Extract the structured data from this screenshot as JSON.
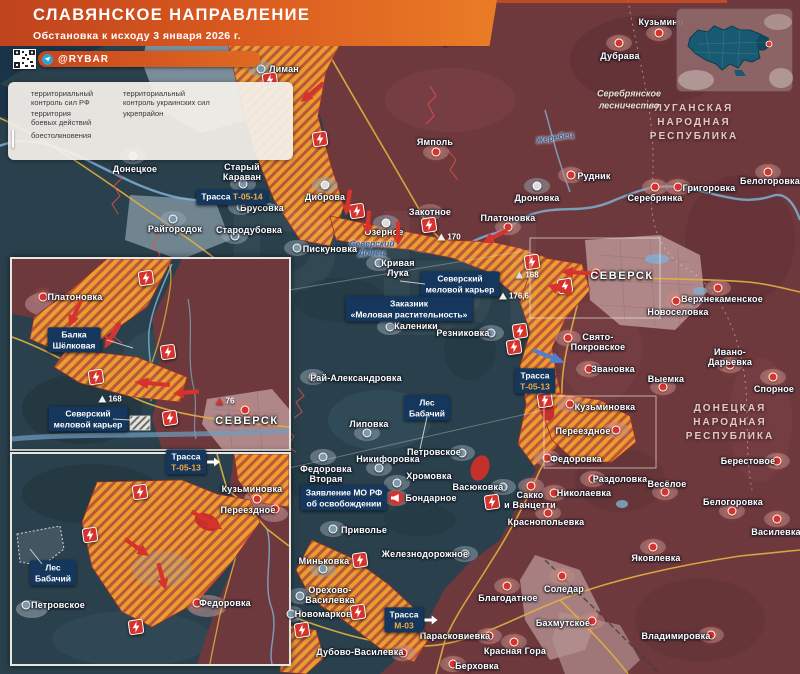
{
  "title": {
    "line1": "СЛАВЯНСКОЕ НАПРАВЛЕНИЕ",
    "line2": "Обстановка к исходу 3 января 2026 г."
  },
  "branding": {
    "handle": "@RYBAR"
  },
  "legend": {
    "items": [
      {
        "icon": "hex-red",
        "label": "территориальный\nконтроль сил РФ"
      },
      {
        "icon": "hex-blue",
        "label": "территориальный\nконтроль украинских сил"
      },
      {
        "icon": "hex-hatch",
        "label": "территория\nбоевых действий"
      },
      {
        "icon": "line-red",
        "label": "укрепрайон"
      },
      {
        "icon": "badge-lightning",
        "label": "боестолкновения"
      }
    ]
  },
  "region_labels": [
    {
      "t": "ЛУГАНСКАЯ\nНАРОДНАЯ\nРЕСПУБЛИКА",
      "x": 694,
      "y": 123
    },
    {
      "t": "ДОНЕЦКАЯ\nНАРОДНАЯ\nРЕСПУБЛИКА",
      "x": 730,
      "y": 423
    }
  ],
  "area_labels": [
    {
      "t": "Серебрянское\nлесничество",
      "x": 629,
      "y": 100
    }
  ],
  "river_labels": [
    {
      "t": "Жеребец",
      "x": 555,
      "y": 138,
      "r": -10
    },
    {
      "t": "Северский\nДонец",
      "x": 372,
      "y": 249,
      "r": 0
    }
  ],
  "towns": [
    {
      "name": "Лиман",
      "m": "blue",
      "x": 261,
      "y": 69,
      "lx": 284,
      "ly": 69
    },
    {
      "name": "Заречное",
      "m": "red",
      "x": 417,
      "y": 21,
      "lx": 417,
      "ly": 12
    },
    {
      "name": "Торское",
      "m": "red",
      "x": 452,
      "y": 31,
      "lx": 452,
      "ly": 41
    },
    {
      "name": "Кузьмино",
      "m": "red",
      "x": 659,
      "y": 33,
      "lx": 661,
      "ly": 22
    },
    {
      "name": "Дубрава",
      "m": "red",
      "x": 619,
      "y": 43,
      "lx": 620,
      "ly": 56
    },
    {
      "name": "Ямполь",
      "m": "red",
      "x": 436,
      "y": 152,
      "lx": 435,
      "ly": 142
    },
    {
      "name": "Диброва",
      "m": "gray",
      "x": 325,
      "y": 185,
      "lx": 325,
      "ly": 197
    },
    {
      "name": "Дроновка",
      "m": "gray",
      "x": 537,
      "y": 186,
      "lx": 537,
      "ly": 198
    },
    {
      "name": "Платоновка",
      "m": "red",
      "x": 508,
      "y": 227,
      "lx": 508,
      "ly": 218
    },
    {
      "name": "Закотное",
      "m": "none",
      "x": 0,
      "y": 0,
      "lx": 430,
      "ly": 212
    },
    {
      "name": "Озерное",
      "m": "gray",
      "x": 386,
      "y": 223,
      "lx": 384,
      "ly": 232
    },
    {
      "name": "Пискуновка",
      "m": "blue",
      "x": 297,
      "y": 248,
      "lx": 330,
      "ly": 249
    },
    {
      "name": "Кривая\nЛука",
      "m": "blue",
      "x": 379,
      "y": 263,
      "lx": 398,
      "ly": 268
    },
    {
      "name": "СЕВЕРСК",
      "m": "red",
      "x": 596,
      "y": 273,
      "lx": 622,
      "ly": 276,
      "big": true
    },
    {
      "name": "Верхнекаменское",
      "m": "red",
      "x": 718,
      "y": 288,
      "lx": 722,
      "ly": 299
    },
    {
      "name": "Новоселовка",
      "m": "red",
      "x": 676,
      "y": 301,
      "lx": 678,
      "ly": 312
    },
    {
      "name": "Свято-\nПокровское",
      "m": "red",
      "x": 568,
      "y": 338,
      "lx": 598,
      "ly": 342
    },
    {
      "name": "Звановка",
      "m": "red",
      "x": 589,
      "y": 369,
      "lx": 613,
      "ly": 369
    },
    {
      "name": "Резниковка",
      "m": "blue",
      "x": 491,
      "y": 333,
      "lx": 463,
      "ly": 333
    },
    {
      "name": "Каленики",
      "m": "blue",
      "x": 390,
      "y": 327,
      "lx": 416,
      "ly": 326
    },
    {
      "name": "Рай-Александровка",
      "m": "blue",
      "x": 313,
      "y": 377,
      "lx": 356,
      "ly": 378
    },
    {
      "name": "Липовка",
      "m": "blue",
      "x": 367,
      "y": 433,
      "lx": 369,
      "ly": 424
    },
    {
      "name": "Никифоровка",
      "m": "blue",
      "x": 379,
      "y": 468,
      "lx": 388,
      "ly": 459
    },
    {
      "name": "Петровское",
      "m": "blue",
      "x": 462,
      "y": 453,
      "lx": 434,
      "ly": 452
    },
    {
      "name": "Федоровка\nВторая",
      "m": "blue",
      "x": 323,
      "y": 457,
      "lx": 326,
      "ly": 474
    },
    {
      "name": "Хромовка",
      "m": "blue",
      "x": 397,
      "y": 483,
      "lx": 429,
      "ly": 476
    },
    {
      "name": "Васюковка",
      "m": "blue",
      "x": 503,
      "y": 487,
      "lx": 478,
      "ly": 487
    },
    {
      "name": "Бондарное",
      "m": "announce",
      "x": 396,
      "y": 498,
      "lx": 431,
      "ly": 498
    },
    {
      "name": "Сакко\nи Ванцетти",
      "m": "red",
      "x": 531,
      "y": 486,
      "lx": 530,
      "ly": 500
    },
    {
      "name": "Краснопольевка",
      "m": "red",
      "x": 548,
      "y": 513,
      "lx": 546,
      "ly": 522
    },
    {
      "name": "Николаевка",
      "m": "red",
      "x": 554,
      "y": 493,
      "lx": 584,
      "ly": 493
    },
    {
      "name": "Раздоловка",
      "m": "red",
      "x": 593,
      "y": 479,
      "lx": 620,
      "ly": 479
    },
    {
      "name": "Приволье",
      "m": "blue",
      "x": 333,
      "y": 529,
      "lx": 364,
      "ly": 530
    },
    {
      "name": "Железнодорожное",
      "m": "blue",
      "x": 465,
      "y": 554,
      "lx": 425,
      "ly": 554
    },
    {
      "name": "Миньковка",
      "m": "blue",
      "x": 323,
      "y": 569,
      "lx": 324,
      "ly": 561
    },
    {
      "name": "Орехово-\nВасилевка",
      "m": "blue",
      "x": 300,
      "y": 596,
      "lx": 330,
      "ly": 595
    },
    {
      "name": "Новомарково",
      "m": "blue",
      "x": 291,
      "y": 614,
      "lx": 326,
      "ly": 614
    },
    {
      "name": "Дубово-Василевка",
      "m": "red",
      "x": 403,
      "y": 653,
      "lx": 360,
      "ly": 652
    },
    {
      "name": "Парасковиевка",
      "m": "red",
      "x": 489,
      "y": 636,
      "lx": 455,
      "ly": 636
    },
    {
      "name": "Благодатное",
      "m": "red",
      "x": 507,
      "y": 586,
      "lx": 508,
      "ly": 598
    },
    {
      "name": "Красная Гора",
      "m": "red",
      "x": 514,
      "y": 642,
      "lx": 515,
      "ly": 651
    },
    {
      "name": "Берховка",
      "m": "red",
      "x": 453,
      "y": 664,
      "lx": 477,
      "ly": 666
    },
    {
      "name": "Соледар",
      "m": "red",
      "x": 562,
      "y": 576,
      "lx": 564,
      "ly": 589
    },
    {
      "name": "Бахмутское",
      "m": "red",
      "x": 592,
      "y": 621,
      "lx": 563,
      "ly": 623
    },
    {
      "name": "Владимировка",
      "m": "red",
      "x": 711,
      "y": 635,
      "lx": 676,
      "ly": 636
    },
    {
      "name": "Яковлевка",
      "m": "red",
      "x": 653,
      "y": 547,
      "lx": 656,
      "ly": 558
    },
    {
      "name": "Весёлое",
      "m": "red",
      "x": 665,
      "y": 492,
      "lx": 667,
      "ly": 484
    },
    {
      "name": "Берестовое",
      "m": "red",
      "x": 777,
      "y": 461,
      "lx": 748,
      "ly": 461
    },
    {
      "name": "Белогоровка",
      "m": "red",
      "x": 732,
      "y": 511,
      "lx": 733,
      "ly": 502
    },
    {
      "name": "Василевка",
      "m": "red",
      "x": 777,
      "y": 519,
      "lx": 776,
      "ly": 532
    },
    {
      "name": "Спорное",
      "m": "red",
      "x": 773,
      "y": 377,
      "lx": 774,
      "ly": 389
    },
    {
      "name": "Ивано-Дарьевка",
      "m": "red",
      "x": 730,
      "y": 365,
      "lx": 730,
      "ly": 357
    },
    {
      "name": "Выемка",
      "m": "red",
      "x": 663,
      "y": 387,
      "lx": 666,
      "ly": 379
    },
    {
      "name": "Кузьминовка",
      "m": "red",
      "x": 570,
      "y": 404,
      "lx": 605,
      "ly": 407
    },
    {
      "name": "Переездное",
      "m": "red",
      "x": 616,
      "y": 430,
      "lx": 583,
      "ly": 431
    },
    {
      "name": "Федоровка",
      "m": "red",
      "x": 547,
      "y": 458,
      "lx": 576,
      "ly": 459
    },
    {
      "name": "Рудник",
      "m": "red",
      "x": 571,
      "y": 175,
      "lx": 594,
      "ly": 176
    },
    {
      "name": "Серебрянка",
      "m": "red",
      "x": 655,
      "y": 187,
      "lx": 655,
      "ly": 198
    },
    {
      "name": "Григоровка",
      "m": "red",
      "x": 678,
      "y": 187,
      "lx": 709,
      "ly": 188
    },
    {
      "name": "Белогоровка",
      "m": "red",
      "x": 768,
      "y": 172,
      "lx": 770,
      "ly": 181
    },
    {
      "name": "Донецкое",
      "m": "gray",
      "x": 133,
      "y": 156,
      "lx": 135,
      "ly": 169
    },
    {
      "name": "Старый\nКараван",
      "m": "blue",
      "x": 243,
      "y": 184,
      "lx": 242,
      "ly": 172
    },
    {
      "name": "Брусовка",
      "m": "blue",
      "x": 241,
      "y": 207,
      "lx": 262,
      "ly": 208
    },
    {
      "name": "Райгородок",
      "m": "blue",
      "x": 173,
      "y": 219,
      "lx": 175,
      "ly": 229
    },
    {
      "name": "Стародубовка",
      "m": "blue",
      "x": 235,
      "y": 236,
      "lx": 249,
      "ly": 230
    },
    {
      "name": "Платоновка",
      "m": "red",
      "x": 43,
      "y": 297,
      "lx": 75,
      "ly": 297
    },
    {
      "name": "СЕВЕРСК",
      "m": "red",
      "x": 245,
      "y": 410,
      "lx": 247,
      "ly": 421,
      "big": true
    },
    {
      "name": "Кузьминовка",
      "m": "red",
      "x": 257,
      "y": 499,
      "lx": 252,
      "ly": 489
    },
    {
      "name": "Переездное",
      "m": "red",
      "x": 275,
      "y": 509,
      "lx": 248,
      "ly": 510
    },
    {
      "name": "Федоровка",
      "m": "red",
      "x": 197,
      "y": 603,
      "lx": 225,
      "ly": 603
    },
    {
      "name": "Петровское",
      "m": "blue",
      "x": 26,
      "y": 605,
      "lx": 58,
      "ly": 605
    }
  ],
  "label_boxes": [
    {
      "x": 232,
      "y": 197,
      "inline": true,
      "lines": [
        {
          "t": "Трасса ",
          "acc": false
        },
        {
          "t": "Т-05-14",
          "acc": true
        }
      ]
    },
    {
      "x": 460,
      "y": 284,
      "lines": [
        {
          "t": "Северский",
          "acc": false
        },
        {
          "t": "меловой карьер",
          "acc": false
        }
      ]
    },
    {
      "x": 409,
      "y": 309,
      "lines": [
        {
          "t": "Заказник",
          "acc": false
        },
        {
          "t": "«Меловая растительность»",
          "acc": false
        }
      ]
    },
    {
      "x": 535,
      "y": 381,
      "lines": [
        {
          "t": "Трасса",
          "acc": false
        },
        {
          "t": "Т-05-13",
          "acc": true
        }
      ]
    },
    {
      "x": 427,
      "y": 408,
      "lines": [
        {
          "t": "Лес",
          "acc": false
        },
        {
          "t": "Бабачий",
          "acc": false
        }
      ]
    },
    {
      "x": 344,
      "y": 498,
      "lines": [
        {
          "t": "Заявление МО РФ",
          "acc": false
        },
        {
          "t": "об освобождении",
          "acc": false
        }
      ]
    },
    {
      "x": 404,
      "y": 620,
      "arrow": true,
      "lines": [
        {
          "t": "Трасса",
          "acc": false
        },
        {
          "t": "М-03",
          "acc": true
        }
      ]
    },
    {
      "x": 74,
      "y": 340,
      "lines": [
        {
          "t": "Балка",
          "acc": false
        },
        {
          "t": "Шёлковая",
          "acc": false
        }
      ]
    },
    {
      "x": 88,
      "y": 419,
      "lines": [
        {
          "t": "Северский",
          "acc": false
        },
        {
          "t": "меловой карьер",
          "acc": false
        }
      ]
    },
    {
      "x": 186,
      "y": 462,
      "arrow": true,
      "lines": [
        {
          "t": "Трасса",
          "acc": false
        },
        {
          "t": "Т-05-13",
          "acc": true
        }
      ]
    },
    {
      "x": 53,
      "y": 573,
      "lines": [
        {
          "t": "Лес",
          "acc": false
        },
        {
          "t": "Бабачий",
          "acc": false
        }
      ]
    }
  ],
  "elevations": [
    {
      "x": 449,
      "y": 237,
      "v": "170",
      "c": "#f2f2f2"
    },
    {
      "x": 527,
      "y": 275,
      "v": "168",
      "c": "#cfe0ea"
    },
    {
      "x": 514,
      "y": 296,
      "v": "176,6",
      "c": "#f2f2f2"
    },
    {
      "x": 110,
      "y": 399,
      "v": "168",
      "c": "#f2f2f2"
    },
    {
      "x": 225,
      "y": 401,
      "v": "76",
      "c": "#d6332d"
    }
  ],
  "badges": [
    {
      "x": 322,
      "y": 17
    },
    {
      "x": 270,
      "y": 80
    },
    {
      "x": 320,
      "y": 139
    },
    {
      "x": 357,
      "y": 211
    },
    {
      "x": 429,
      "y": 225
    },
    {
      "x": 532,
      "y": 262
    },
    {
      "x": 565,
      "y": 286
    },
    {
      "x": 520,
      "y": 331
    },
    {
      "x": 514,
      "y": 347
    },
    {
      "x": 545,
      "y": 400
    },
    {
      "x": 492,
      "y": 502
    },
    {
      "x": 360,
      "y": 560
    },
    {
      "x": 358,
      "y": 612
    },
    {
      "x": 302,
      "y": 630
    },
    {
      "x": 146,
      "y": 278
    },
    {
      "x": 168,
      "y": 352
    },
    {
      "x": 96,
      "y": 377
    },
    {
      "x": 170,
      "y": 418
    },
    {
      "x": 140,
      "y": 492
    },
    {
      "x": 90,
      "y": 535
    },
    {
      "x": 136,
      "y": 627
    }
  ],
  "arrows": [
    {
      "x": 347,
      "y": 24,
      "r": 192,
      "len": 34,
      "c": "red"
    },
    {
      "x": 312,
      "y": 92,
      "r": 140,
      "len": 30,
      "c": "red"
    },
    {
      "x": 348,
      "y": 202,
      "r": 100,
      "len": 26,
      "c": "red"
    },
    {
      "x": 368,
      "y": 222,
      "r": 95,
      "len": 24,
      "c": "red"
    },
    {
      "x": 398,
      "y": 233,
      "r": 90,
      "len": 24,
      "c": "red"
    },
    {
      "x": 495,
      "y": 236,
      "r": 152,
      "len": 28,
      "c": "red"
    },
    {
      "x": 576,
      "y": 272,
      "r": 183,
      "len": 30,
      "c": "red"
    },
    {
      "x": 560,
      "y": 289,
      "r": 200,
      "len": 26,
      "c": "red"
    },
    {
      "x": 549,
      "y": 356,
      "r": 22,
      "len": 34,
      "c": "blue"
    },
    {
      "x": 75,
      "y": 313,
      "r": 115,
      "len": 30,
      "c": "red"
    },
    {
      "x": 112,
      "y": 335,
      "r": 120,
      "len": 30,
      "c": "red"
    },
    {
      "x": 152,
      "y": 383,
      "r": 185,
      "len": 36,
      "c": "red"
    },
    {
      "x": 186,
      "y": 392,
      "r": 175,
      "len": 26,
      "c": "red"
    },
    {
      "x": 137,
      "y": 547,
      "r": 35,
      "len": 30,
      "c": "red"
    },
    {
      "x": 207,
      "y": 520,
      "r": 30,
      "len": 36,
      "c": "red"
    },
    {
      "x": 162,
      "y": 576,
      "r": 75,
      "len": 28,
      "c": "red"
    }
  ],
  "connectors": {
    "rects": [
      {
        "x": 530,
        "y": 238,
        "w": 130,
        "h": 80
      },
      {
        "x": 544,
        "y": 396,
        "w": 112,
        "h": 72
      }
    ],
    "lines": [
      {
        "x1": 107,
        "y1": 340,
        "x2": 133,
        "y2": 348
      },
      {
        "x1": 113,
        "y1": 419,
        "x2": 131,
        "y2": 420
      },
      {
        "x1": 425,
        "y1": 284,
        "x2": 400,
        "y2": 281
      },
      {
        "x1": 427,
        "y1": 417,
        "x2": 420,
        "y2": 449
      },
      {
        "x1": 42,
        "y1": 564,
        "x2": 30,
        "y2": 549
      },
      {
        "x1": 530,
        "y1": 250,
        "x2": 289,
        "y2": 290
      },
      {
        "x1": 544,
        "y1": 410,
        "x2": 289,
        "y2": 468
      }
    ]
  },
  "colors": {
    "rf_control": "#6e393d",
    "ua_control": "#2a414d",
    "combat_zone": "#efa22f",
    "combat_stripe": "#c2563a",
    "clash_red": "#d6332d",
    "arrow_blue": "#4f7fd0",
    "label_box_navy": "#15375d",
    "road_accent": "#f6a93d",
    "banner_orange": "#d9581f",
    "telegram_blue": "#2ea3d6",
    "river_blue": "#7fb0d3",
    "road_yellow": "#e3b13f"
  }
}
